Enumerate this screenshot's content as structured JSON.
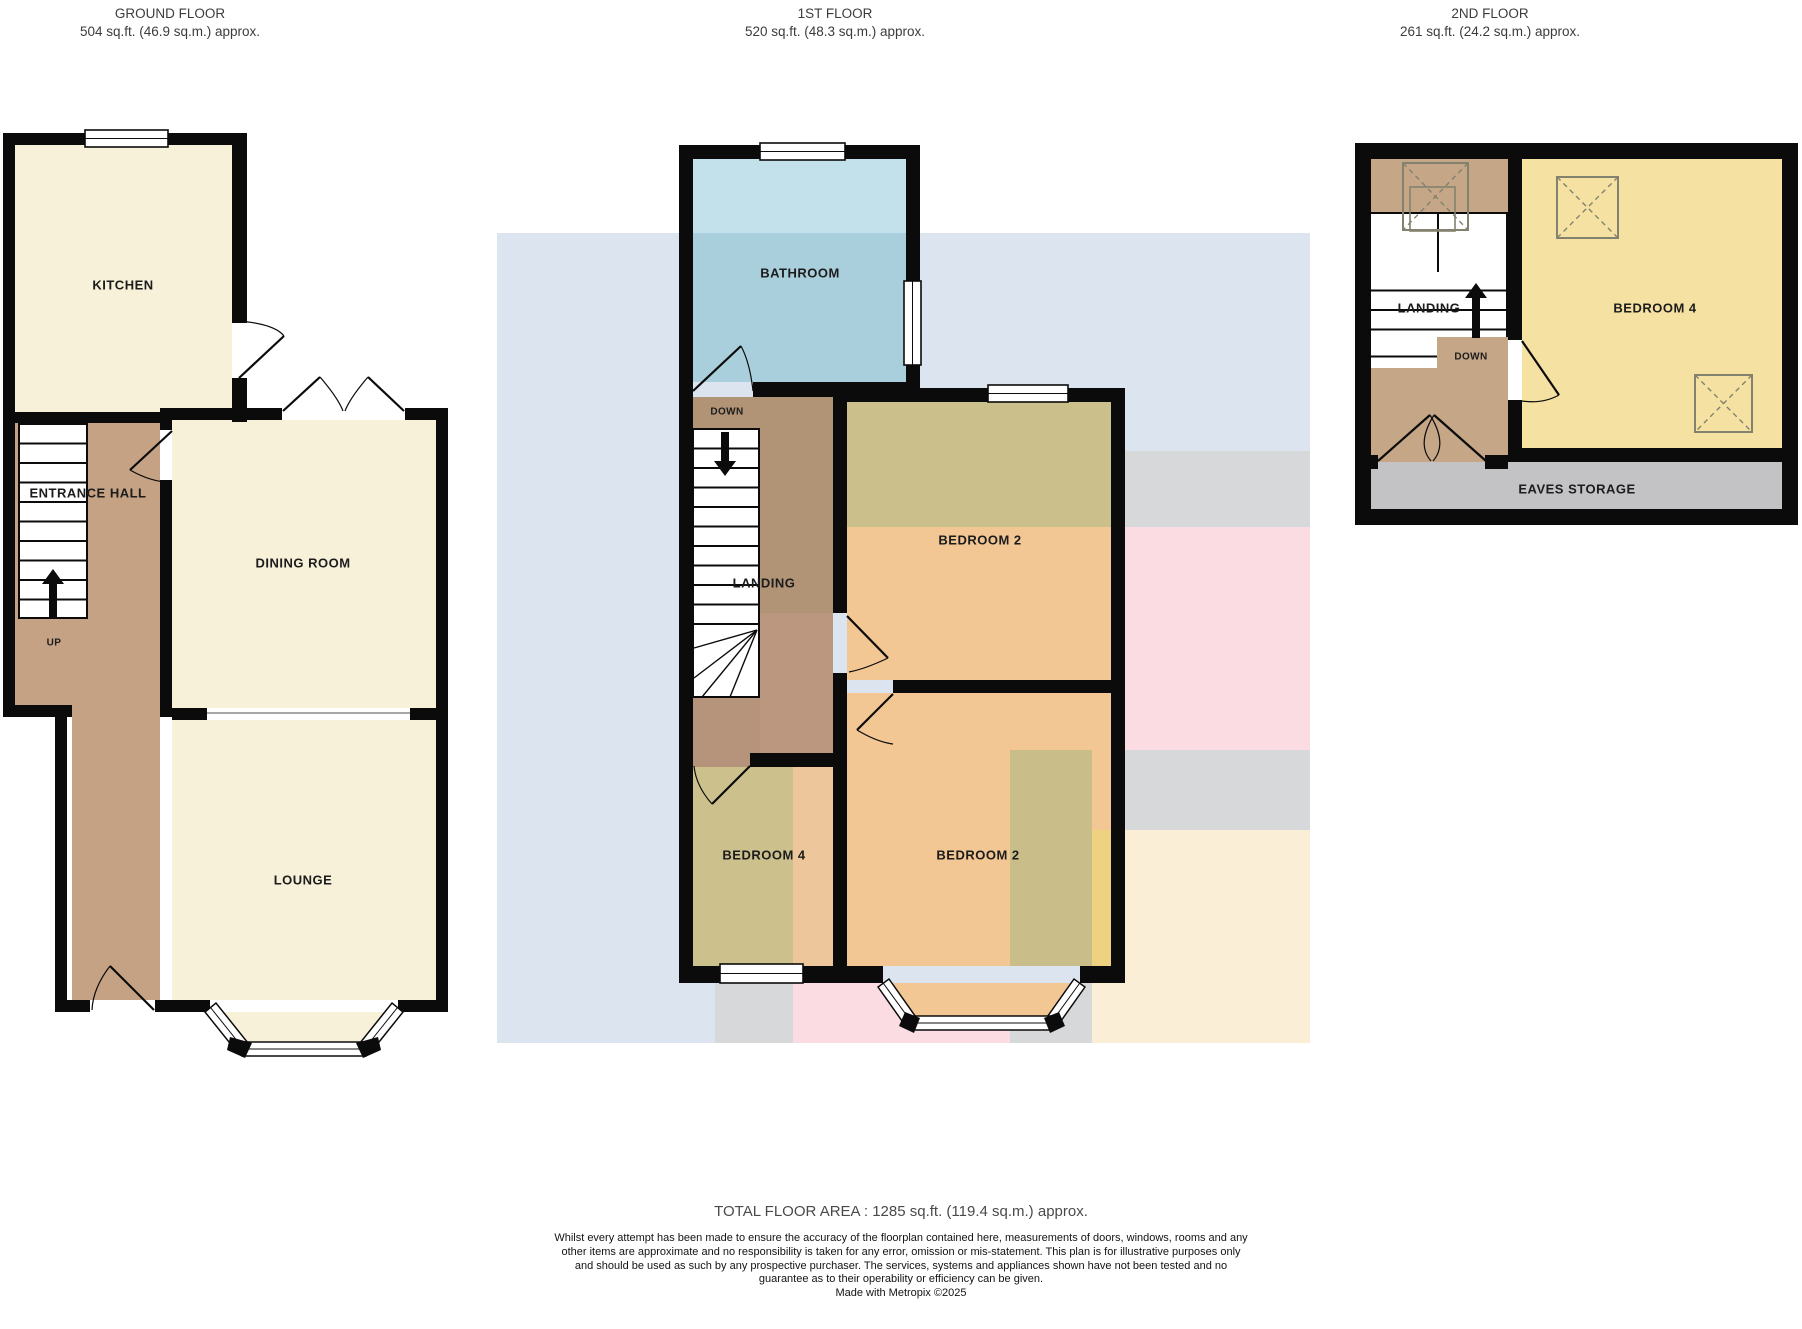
{
  "headers": {
    "ground": {
      "title": "GROUND FLOOR",
      "subtitle": "504 sq.ft. (46.9 sq.m.) approx."
    },
    "first": {
      "title": "1ST FLOOR",
      "subtitle": "520 sq.ft. (48.3 sq.m.) approx."
    },
    "second": {
      "title": "2ND FLOOR",
      "subtitle": "261 sq.ft. (24.2 sq.m.) approx."
    }
  },
  "ground": {
    "kitchen": "KITCHEN",
    "entrance_hall": "ENTRANCE HALL",
    "dining_room": "DINING ROOM",
    "lounge": "LOUNGE",
    "up": "UP"
  },
  "first": {
    "bathroom": "BATHROOM",
    "down": "DOWN",
    "landing": "LANDING",
    "bedroom2_top": "BEDROOM 2",
    "bedroom4": "BEDROOM 4",
    "bedroom2_bottom": "BEDROOM 2"
  },
  "second": {
    "landing": "LANDING",
    "down": "DOWN",
    "bedroom4": "BEDROOM 4",
    "eaves_storage": "EAVES STORAGE"
  },
  "footer": {
    "total": "TOTAL FLOOR AREA : 1285 sq.ft. (119.4 sq.m.) approx.",
    "disclaimer": "Whilst every attempt has been made to ensure the accuracy of the floorplan contained here, measurements of doors, windows, rooms and any other items are approximate and no responsibility is taken for any error, omission or mis-statement. This plan is for illustrative purposes only and should be used as such by any prospective purchaser. The services, systems and appliances shown have not been tested and no guarantee as to their operability or efficiency can be given.",
    "credit": "Made with Metropix ©2025"
  },
  "colors": {
    "wall": "#0b0b0b",
    "cream_room": "#f8f1da",
    "hall_tan": "#c5a284",
    "bathroom_blue": "#aacfdc",
    "corridor_tan": "#b19376",
    "olive": "#cbc08c",
    "peach": "#f2c794",
    "second_floor_yellow": "#f5e2a2",
    "eaves_grey": "#c3c3c5",
    "bg_blue": "#dbe4ef",
    "bg_grey": "#d7d8da",
    "bg_pink": "#fadce2",
    "bg_cream": "#faeed6"
  }
}
